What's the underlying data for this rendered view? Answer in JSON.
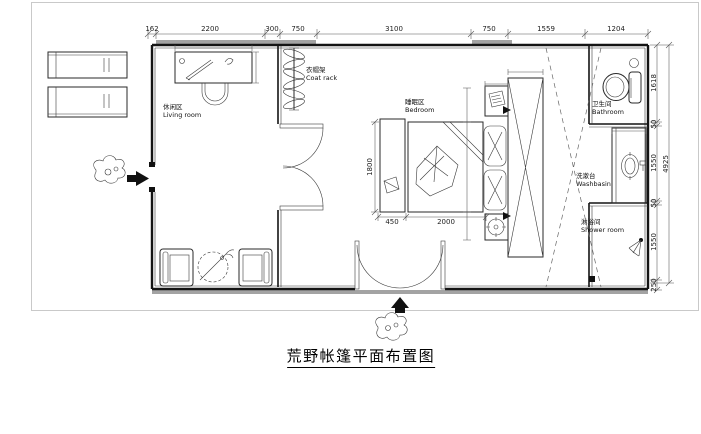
{
  "title": "荒野帐篷平面布置图",
  "rooms": {
    "living": {
      "cn": "休闲区",
      "en": "Living room"
    },
    "coat_rack": {
      "cn": "衣帽架",
      "en": "Coat rack"
    },
    "bedroom": {
      "cn": "睡眠区",
      "en": "Bedroom"
    },
    "bathroom": {
      "cn": "卫生间",
      "en": "Bathroom"
    },
    "washbasin": {
      "cn": "洗漱台",
      "en": "Washbasin"
    },
    "shower": {
      "cn": "淋浴间",
      "en": "Shower room"
    }
  },
  "dimensions": {
    "top": [
      "162",
      "2200",
      "300",
      "750",
      "3100",
      "750",
      "1559",
      "1204"
    ],
    "right": [
      "1618",
      "50",
      "1550",
      "50",
      "1550",
      "250"
    ],
    "right_overall": "4925",
    "bed": {
      "bench": "450",
      "bed": "2000",
      "length": "1800"
    }
  },
  "colors": {
    "wall": "#141414",
    "dimension": "#555555",
    "step_fill": "#a3a3a3",
    "sheet_frame": "#c9c9c9"
  }
}
